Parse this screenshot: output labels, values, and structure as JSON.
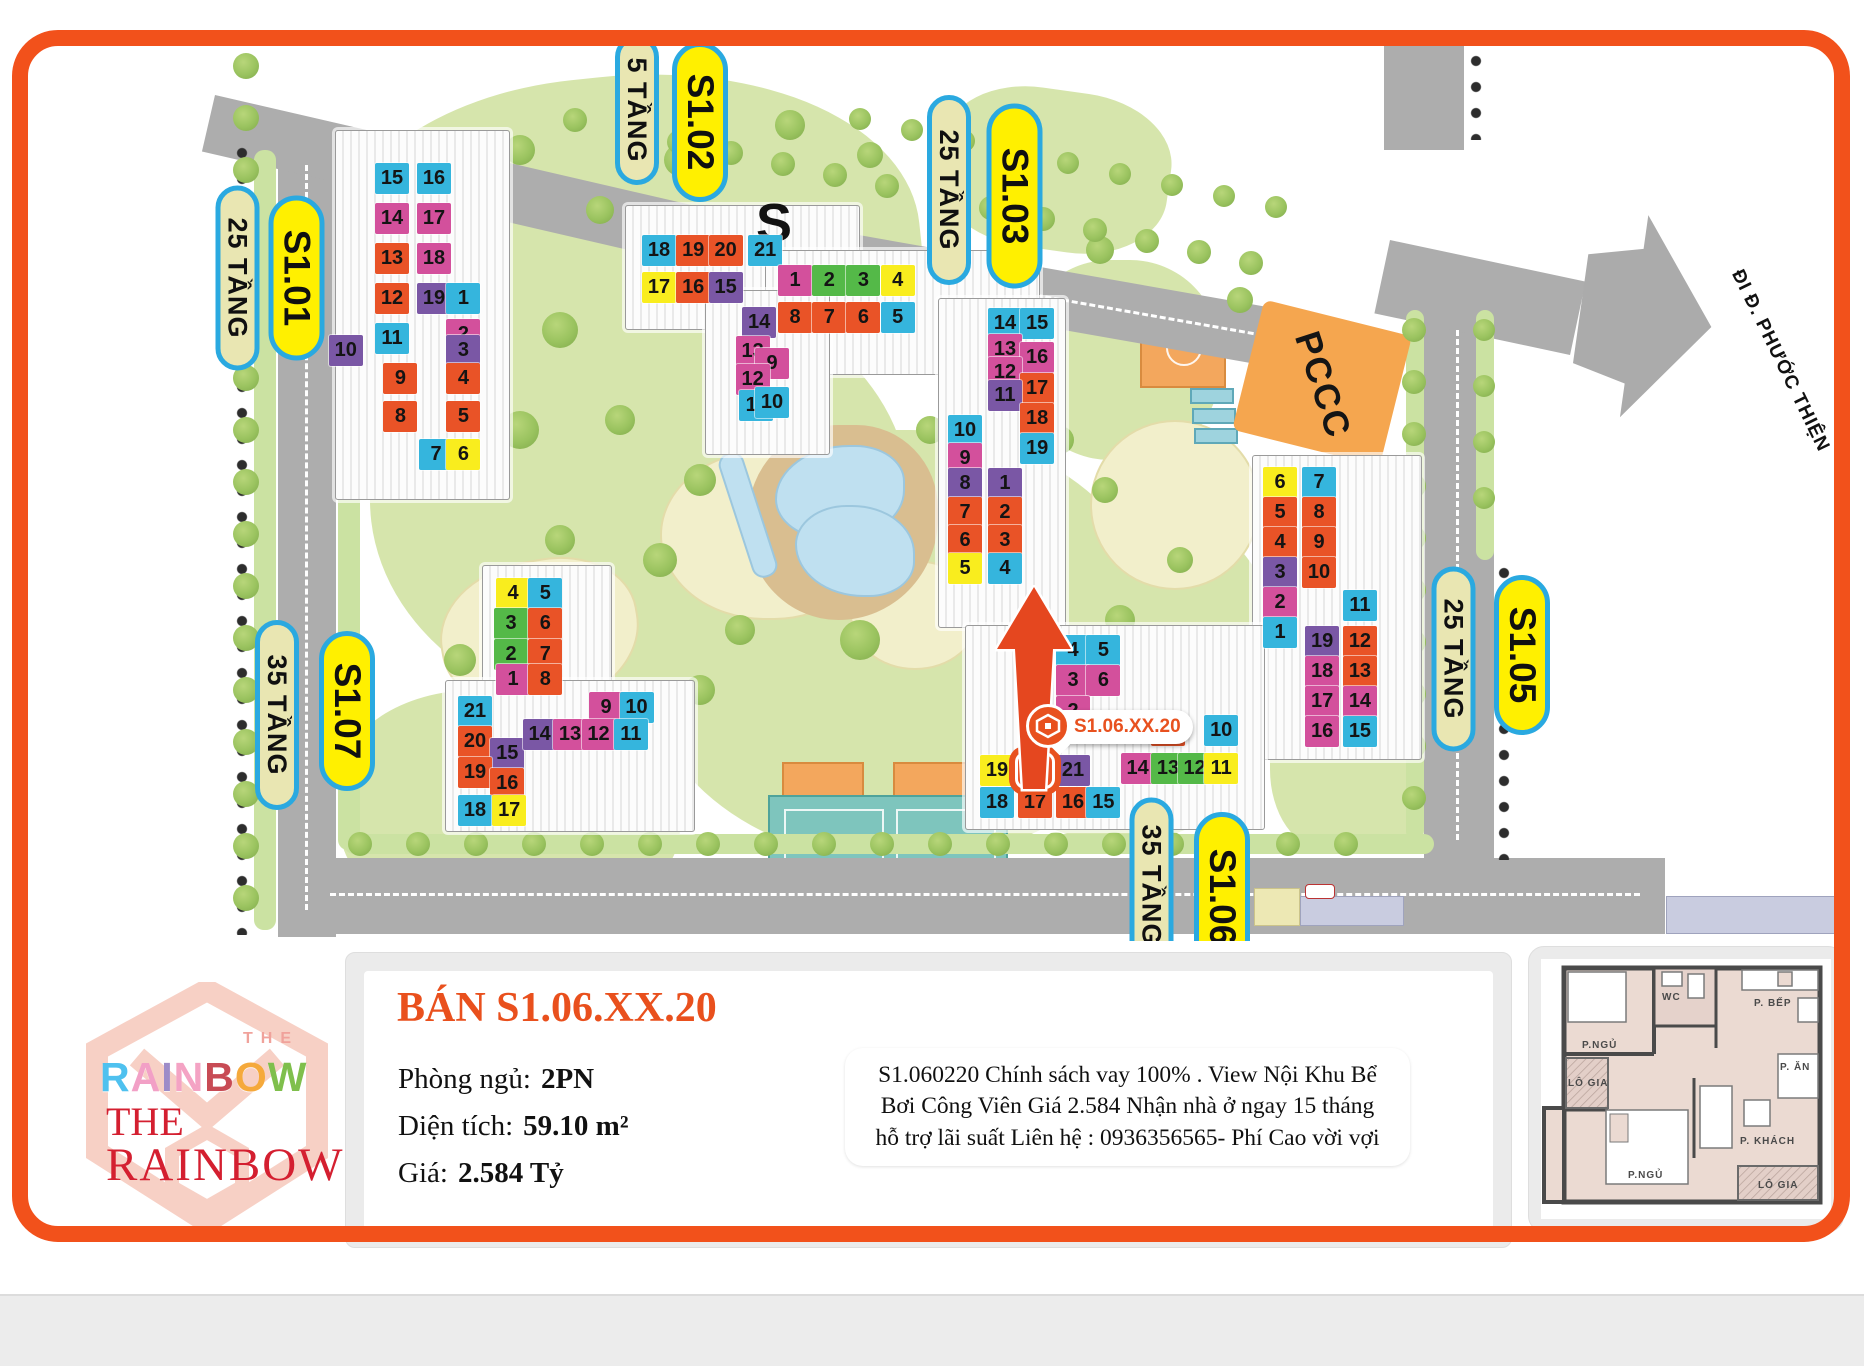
{
  "page": {
    "frame_color": "#F2511B"
  },
  "colors": {
    "cy": "#35B5DD",
    "mg": "#D3509C",
    "or": "#E95327",
    "pu": "#7A57A5",
    "ye": "#F9ED1E",
    "gr": "#54B948"
  },
  "map": {
    "road_sign": "ĐI Đ. PHƯỚC THIỆN",
    "pccc_label": "PCCC",
    "s_watermark": "S",
    "marker": {
      "label": "S1.06.XX.20"
    },
    "labels": [
      {
        "text": "25 TẦNG",
        "variant": "tan",
        "cx": 237,
        "cy": 278,
        "len": 185
      },
      {
        "text": "S1.01",
        "variant": "yellow",
        "cx": 296,
        "cy": 278,
        "len": 165
      },
      {
        "text": "5 TẦNG",
        "variant": "tan",
        "cx": 637,
        "cy": 110,
        "len": 150
      },
      {
        "text": "S1.02",
        "variant": "yellow",
        "cx": 700,
        "cy": 122,
        "len": 160
      },
      {
        "text": "25 TẦNG",
        "variant": "tan",
        "cx": 949,
        "cy": 190,
        "len": 190
      },
      {
        "text": "S1.03",
        "variant": "yellow",
        "cx": 1014,
        "cy": 196,
        "len": 185
      },
      {
        "text": "25 TẦNG",
        "variant": "tan",
        "cx": 1453,
        "cy": 659,
        "len": 185
      },
      {
        "text": "S1.05",
        "variant": "yellow",
        "cx": 1522,
        "cy": 655,
        "len": 160
      },
      {
        "text": "35 TẦNG",
        "variant": "tan",
        "cx": 277,
        "cy": 715,
        "len": 190
      },
      {
        "text": "S1.07",
        "variant": "yellow",
        "cx": 347,
        "cy": 711,
        "len": 160
      },
      {
        "text": "35 TẦNG",
        "variant": "tan",
        "cx": 1151,
        "cy": 885,
        "len": 175
      },
      {
        "text": "S1.06",
        "variant": "yellow",
        "cx": 1222,
        "cy": 897,
        "len": 170
      }
    ],
    "buildings": [
      {
        "id": "S1.01",
        "origin": [
          375,
          163
        ],
        "pitch": [
          42,
          40
        ],
        "highlight": null,
        "pads": [
          [
            335,
            130,
            175,
            370
          ]
        ],
        "units": [
          {
            "n": "15",
            "c": "cy",
            "col": 0,
            "row": 0
          },
          {
            "n": "16",
            "c": "cy",
            "col": 1,
            "row": 0
          },
          {
            "n": "14",
            "c": "mg",
            "col": 0,
            "row": 1
          },
          {
            "n": "17",
            "c": "mg",
            "col": 1,
            "row": 1
          },
          {
            "n": "13",
            "c": "or",
            "col": 0,
            "row": 2
          },
          {
            "n": "18",
            "c": "mg",
            "col": 1,
            "row": 2
          },
          {
            "n": "12",
            "c": "or",
            "col": 0,
            "row": 3
          },
          {
            "n": "19",
            "c": "pu",
            "col": 1,
            "row": 3
          },
          {
            "n": "11",
            "c": "cy",
            "col": 0,
            "row": 4
          },
          {
            "n": "1",
            "c": "cy",
            "col": 1.7,
            "row": 3.0
          },
          {
            "n": "2",
            "c": "mg",
            "col": 1.7,
            "row": 3.9
          },
          {
            "n": "10",
            "c": "pu",
            "col": -1.1,
            "row": 4.3
          },
          {
            "n": "3",
            "c": "pu",
            "col": 1.7,
            "row": 4.3
          },
          {
            "n": "9",
            "c": "or",
            "col": 0.2,
            "row": 5.0
          },
          {
            "n": "4",
            "c": "or",
            "col": 1.7,
            "row": 5.0
          },
          {
            "n": "8",
            "c": "or",
            "col": 0.2,
            "row": 5.95
          },
          {
            "n": "5",
            "c": "or",
            "col": 1.7,
            "row": 5.95
          },
          {
            "n": "7",
            "c": "cy",
            "col": 1.05,
            "row": 6.9
          },
          {
            "n": "6",
            "c": "ye",
            "col": 1.7,
            "row": 6.9
          }
        ]
      },
      {
        "id": "S1.02",
        "origin": [
          642,
          235
        ],
        "pitch": [
          36,
          37
        ],
        "highlight": null,
        "pads": [
          [
            625,
            205,
            235,
            125
          ],
          [
            765,
            250,
            275,
            125
          ],
          [
            705,
            290,
            125,
            165
          ]
        ],
        "units": [
          {
            "n": "18",
            "c": "cy",
            "col": 0,
            "row": 0
          },
          {
            "n": "19",
            "c": "or",
            "col": 0.95,
            "row": 0
          },
          {
            "n": "20",
            "c": "or",
            "col": 1.85,
            "row": 0
          },
          {
            "n": "21",
            "c": "cy",
            "col": 2.95,
            "row": 0
          },
          {
            "n": "17",
            "c": "ye",
            "col": 0,
            "row": 1
          },
          {
            "n": "16",
            "c": "or",
            "col": 0.95,
            "row": 1
          },
          {
            "n": "15",
            "c": "pu",
            "col": 1.85,
            "row": 1
          },
          {
            "n": "1",
            "c": "mg",
            "col": 3.78,
            "row": 0.8
          },
          {
            "n": "2",
            "c": "gr",
            "col": 4.73,
            "row": 0.8
          },
          {
            "n": "3",
            "c": "gr",
            "col": 5.68,
            "row": 0.8
          },
          {
            "n": "4",
            "c": "ye",
            "col": 6.63,
            "row": 0.8
          },
          {
            "n": "8",
            "c": "or",
            "col": 3.78,
            "row": 1.8
          },
          {
            "n": "7",
            "c": "or",
            "col": 4.73,
            "row": 1.8
          },
          {
            "n": "6",
            "c": "or",
            "col": 5.68,
            "row": 1.8
          },
          {
            "n": "5",
            "c": "cy",
            "col": 6.63,
            "row": 1.8
          },
          {
            "n": "14",
            "c": "pu",
            "col": 2.78,
            "row": 1.95
          },
          {
            "n": "13",
            "c": "mg",
            "col": 2.6,
            "row": 2.73
          },
          {
            "n": "9",
            "c": "mg",
            "col": 3.14,
            "row": 3.05
          },
          {
            "n": "12",
            "c": "mg",
            "col": 2.6,
            "row": 3.49
          },
          {
            "n": "11",
            "c": "cy",
            "col": 2.7,
            "row": 4.19
          },
          {
            "n": "10",
            "c": "cy",
            "col": 3.14,
            "row": 4.11
          }
        ]
      },
      {
        "id": "S1.03",
        "origin": [
          948,
          308
        ],
        "pitch": [
          37,
          33
        ],
        "highlight": null,
        "pads": [
          [
            938,
            298,
            128,
            330
          ]
        ],
        "units": [
          {
            "n": "14",
            "c": "cy",
            "col": 1.08,
            "row": 0
          },
          {
            "n": "15",
            "c": "cy",
            "col": 1.95,
            "row": 0
          },
          {
            "n": "13",
            "c": "mg",
            "col": 1.08,
            "row": 0.8
          },
          {
            "n": "16",
            "c": "mg",
            "col": 1.95,
            "row": 1.03
          },
          {
            "n": "12",
            "c": "mg",
            "col": 1.08,
            "row": 1.48
          },
          {
            "n": "17",
            "c": "or",
            "col": 1.95,
            "row": 1.97
          },
          {
            "n": "11",
            "c": "pu",
            "col": 1.08,
            "row": 2.18
          },
          {
            "n": "18",
            "c": "or",
            "col": 1.95,
            "row": 2.88
          },
          {
            "n": "10",
            "c": "cy",
            "col": 0,
            "row": 3.24
          },
          {
            "n": "19",
            "c": "cy",
            "col": 1.95,
            "row": 3.79
          },
          {
            "n": "9",
            "c": "mg",
            "col": 0,
            "row": 4.09
          },
          {
            "n": "8",
            "c": "pu",
            "col": 0,
            "row": 4.85
          },
          {
            "n": "1",
            "c": "pu",
            "col": 1.08,
            "row": 4.85
          },
          {
            "n": "7",
            "c": "or",
            "col": 0,
            "row": 5.73
          },
          {
            "n": "2",
            "c": "or",
            "col": 1.08,
            "row": 5.73
          },
          {
            "n": "6",
            "c": "or",
            "col": 0,
            "row": 6.58
          },
          {
            "n": "3",
            "c": "or",
            "col": 1.08,
            "row": 6.58
          },
          {
            "n": "5",
            "c": "ye",
            "col": 0,
            "row": 7.42
          },
          {
            "n": "4",
            "c": "cy",
            "col": 1.08,
            "row": 7.42
          }
        ]
      },
      {
        "id": "S1.05",
        "origin": [
          1263,
          467
        ],
        "pitch": [
          39,
          30
        ],
        "highlight": null,
        "pads": [
          [
            1252,
            455,
            170,
            305
          ]
        ],
        "units": [
          {
            "n": "6",
            "c": "ye",
            "col": 0,
            "row": 0
          },
          {
            "n": "7",
            "c": "cy",
            "col": 1,
            "row": 0
          },
          {
            "n": "5",
            "c": "or",
            "col": 0,
            "row": 1
          },
          {
            "n": "8",
            "c": "or",
            "col": 1,
            "row": 1
          },
          {
            "n": "4",
            "c": "or",
            "col": 0,
            "row": 2
          },
          {
            "n": "9",
            "c": "or",
            "col": 1,
            "row": 2
          },
          {
            "n": "3",
            "c": "pu",
            "col": 0,
            "row": 3
          },
          {
            "n": "10",
            "c": "or",
            "col": 1,
            "row": 3
          },
          {
            "n": "2",
            "c": "mg",
            "col": 0,
            "row": 4
          },
          {
            "n": "1",
            "c": "cy",
            "col": 0,
            "row": 5
          },
          {
            "n": "11",
            "c": "cy",
            "col": 2.05,
            "row": 4.1
          },
          {
            "n": "19",
            "c": "pu",
            "col": 1.08,
            "row": 5.3
          },
          {
            "n": "12",
            "c": "or",
            "col": 2.05,
            "row": 5.3
          },
          {
            "n": "18",
            "c": "mg",
            "col": 1.08,
            "row": 6.3
          },
          {
            "n": "13",
            "c": "or",
            "col": 2.05,
            "row": 6.3
          },
          {
            "n": "17",
            "c": "mg",
            "col": 1.08,
            "row": 7.3
          },
          {
            "n": "14",
            "c": "mg",
            "col": 2.05,
            "row": 7.3
          },
          {
            "n": "16",
            "c": "mg",
            "col": 1.08,
            "row": 8.3
          },
          {
            "n": "15",
            "c": "cy",
            "col": 2.05,
            "row": 8.3
          }
        ]
      },
      {
        "id": "S1.06",
        "origin": [
          980,
          635
        ],
        "pitch": [
          38,
          38
        ],
        "highlight": "20",
        "pads": [
          [
            965,
            625,
            300,
            205
          ]
        ],
        "units": [
          {
            "n": "4",
            "c": "cy",
            "col": 2.0,
            "row": 0
          },
          {
            "n": "5",
            "c": "cy",
            "col": 2.8,
            "row": 0
          },
          {
            "n": "3",
            "c": "mg",
            "col": 2.0,
            "row": 0.8
          },
          {
            "n": "6",
            "c": "mg",
            "col": 2.8,
            "row": 0.8
          },
          {
            "n": "2",
            "c": "mg",
            "col": 2.0,
            "row": 1.6
          },
          {
            "n": "9",
            "c": "or",
            "col": 4.5,
            "row": 2.1
          },
          {
            "n": "10",
            "c": "cy",
            "col": 5.9,
            "row": 2.1
          },
          {
            "n": "19",
            "c": "ye",
            "col": 0,
            "row": 3.15
          },
          {
            "n": "20",
            "c": "or",
            "col": 1.0,
            "row": 3.15
          },
          {
            "n": "21",
            "c": "pu",
            "col": 2.0,
            "row": 3.15
          },
          {
            "n": "14",
            "c": "mg",
            "col": 3.7,
            "row": 3.1
          },
          {
            "n": "13",
            "c": "gr",
            "col": 4.5,
            "row": 3.1
          },
          {
            "n": "12",
            "c": "gr",
            "col": 5.2,
            "row": 3.1
          },
          {
            "n": "11",
            "c": "ye",
            "col": 5.9,
            "row": 3.1
          },
          {
            "n": "18",
            "c": "cy",
            "col": 0,
            "row": 4.0
          },
          {
            "n": "17",
            "c": "or",
            "col": 1.0,
            "row": 4.0
          },
          {
            "n": "16",
            "c": "or",
            "col": 2.0,
            "row": 4.0
          },
          {
            "n": "15",
            "c": "cy",
            "col": 2.8,
            "row": 4.0
          }
        ]
      },
      {
        "id": "S1.07",
        "origin": [
          458,
          578
        ],
        "pitch": [
          38,
          38
        ],
        "highlight": null,
        "pads": [
          [
            482,
            565,
            130,
            150
          ],
          [
            445,
            680,
            250,
            152
          ]
        ],
        "units": [
          {
            "n": "4",
            "c": "ye",
            "col": 1.0,
            "row": 0
          },
          {
            "n": "5",
            "c": "cy",
            "col": 1.85,
            "row": 0
          },
          {
            "n": "3",
            "c": "gr",
            "col": 0.95,
            "row": 0.8
          },
          {
            "n": "6",
            "c": "or",
            "col": 1.85,
            "row": 0.8
          },
          {
            "n": "2",
            "c": "gr",
            "col": 0.95,
            "row": 1.6
          },
          {
            "n": "7",
            "c": "or",
            "col": 1.85,
            "row": 1.6
          },
          {
            "n": "1",
            "c": "mg",
            "col": 1.0,
            "row": 2.25
          },
          {
            "n": "8",
            "c": "or",
            "col": 1.85,
            "row": 2.25
          },
          {
            "n": "21",
            "c": "cy",
            "col": 0,
            "row": 3.1
          },
          {
            "n": "20",
            "c": "or",
            "col": 0,
            "row": 3.9
          },
          {
            "n": "15",
            "c": "pu",
            "col": 0.85,
            "row": 4.2
          },
          {
            "n": "19",
            "c": "or",
            "col": 0,
            "row": 4.7
          },
          {
            "n": "16",
            "c": "or",
            "col": 0.85,
            "row": 5.0
          },
          {
            "n": "18",
            "c": "cy",
            "col": 0,
            "row": 5.7
          },
          {
            "n": "17",
            "c": "ye",
            "col": 0.9,
            "row": 5.7
          },
          {
            "n": "9",
            "c": "mg",
            "col": 3.45,
            "row": 3.0
          },
          {
            "n": "10",
            "c": "cy",
            "col": 4.25,
            "row": 3.0
          },
          {
            "n": "14",
            "c": "pu",
            "col": 1.7,
            "row": 3.7
          },
          {
            "n": "13",
            "c": "mg",
            "col": 2.5,
            "row": 3.7
          },
          {
            "n": "12",
            "c": "mg",
            "col": 3.25,
            "row": 3.7
          },
          {
            "n": "11",
            "c": "cy",
            "col": 4.1,
            "row": 3.7
          }
        ]
      }
    ]
  },
  "info_panel": {
    "title": "BÁN S1.06.XX.20",
    "rows": [
      {
        "label": "Phòng ngủ:",
        "value": "2PN"
      },
      {
        "label": "Diện tích:",
        "value": "59.10 m²"
      },
      {
        "label": "Giá:",
        "value": "2.584 Tỷ"
      }
    ],
    "description": "S1.060220 Chính sách vay 100% . View Nội Khu Bể Bơi Công Viên Giá 2.584 Nhận nhà ở ngay 15 tháng hỗ trợ lãi suất Liên hệ : 0936356565- Phí Cao vời vợi"
  },
  "logo": {
    "the_small": "THE",
    "rainbow_letters": [
      {
        "ch": "R",
        "c": "#4FC1EF"
      },
      {
        "ch": "A",
        "c": "#F2A0C6"
      },
      {
        "ch": "I",
        "c": "#9D8CC8"
      },
      {
        "ch": "N",
        "c": "#F4A3C4"
      },
      {
        "ch": "B",
        "c": "#C84B55"
      },
      {
        "ch": "O",
        "c": "#F5A93B"
      },
      {
        "ch": "W",
        "c": "#7FBF4C"
      }
    ],
    "the_big": "THE",
    "rainbow_big": "RAINBOW"
  },
  "floorplan": {
    "rooms": [
      "P.NGỦ",
      "WC",
      "P. BẾP",
      "LÔ GIA",
      "P. ĂN",
      "P. KHÁCH",
      "P.NGỦ",
      "LÔ GIA"
    ]
  }
}
